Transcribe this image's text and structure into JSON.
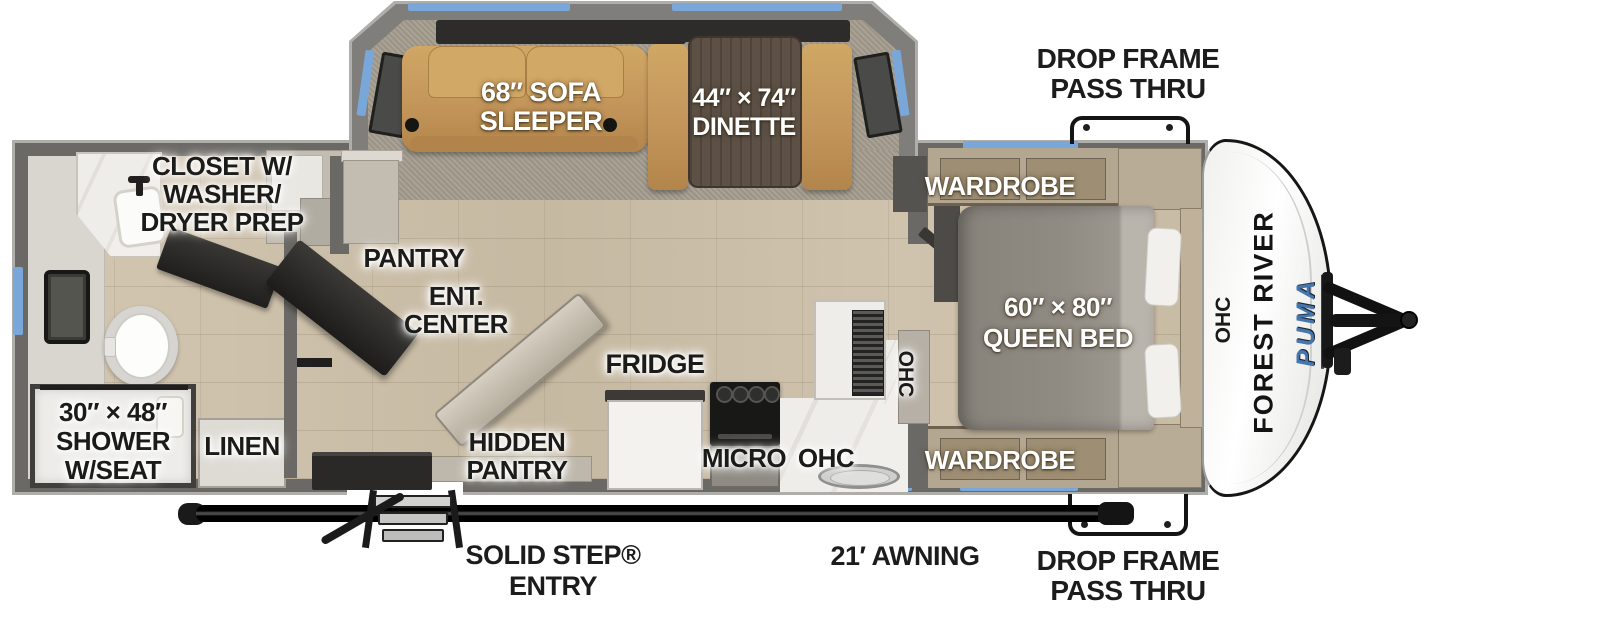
{
  "colors": {
    "window_blue": "#7aa7d9",
    "sofa_tan": "#c79c5e",
    "wall_gray": "#6b6965",
    "brand_blue": "#4576ad"
  },
  "slideout": {
    "sofa_label": [
      "68″ SOFA",
      "SLEEPER"
    ],
    "dinette_label": [
      "44″ × 74″",
      "DINETTE"
    ]
  },
  "bathroom": {
    "closet_label": [
      "CLOSET W/",
      "WASHER/",
      "DRYER PREP"
    ],
    "shower_label": [
      "30″ × 48″",
      "SHOWER",
      "W/SEAT"
    ],
    "linen_label": "LINEN"
  },
  "galley": {
    "pantry_label": "PANTRY",
    "ent_center_label": [
      "ENT.",
      "CENTER"
    ],
    "hidden_pantry_label": [
      "HIDDEN",
      "PANTRY"
    ],
    "fridge_label": "FRIDGE",
    "micro_label": "MICRO",
    "ohc_label": "OHC",
    "ohc_side_label": "OHC"
  },
  "bedroom": {
    "wardrobe_top_label": "WARDROBE",
    "wardrobe_bottom_label": "WARDROBE",
    "bed_label": [
      "60″ × 80″",
      "QUEEN BED"
    ],
    "ohc_front_label": "OHC"
  },
  "exterior": {
    "drop_frame_top_label": [
      "DROP FRAME",
      "PASS THRU"
    ],
    "drop_frame_bottom_label": [
      "DROP FRAME",
      "PASS THRU"
    ],
    "entry_label": [
      "SOLID STEP®",
      "ENTRY"
    ],
    "awning_label": "21′ AWNING"
  },
  "branding": {
    "manufacturer": "FOREST RIVER",
    "model": "PUMA",
    "model_tagline": "TRAILERS"
  }
}
